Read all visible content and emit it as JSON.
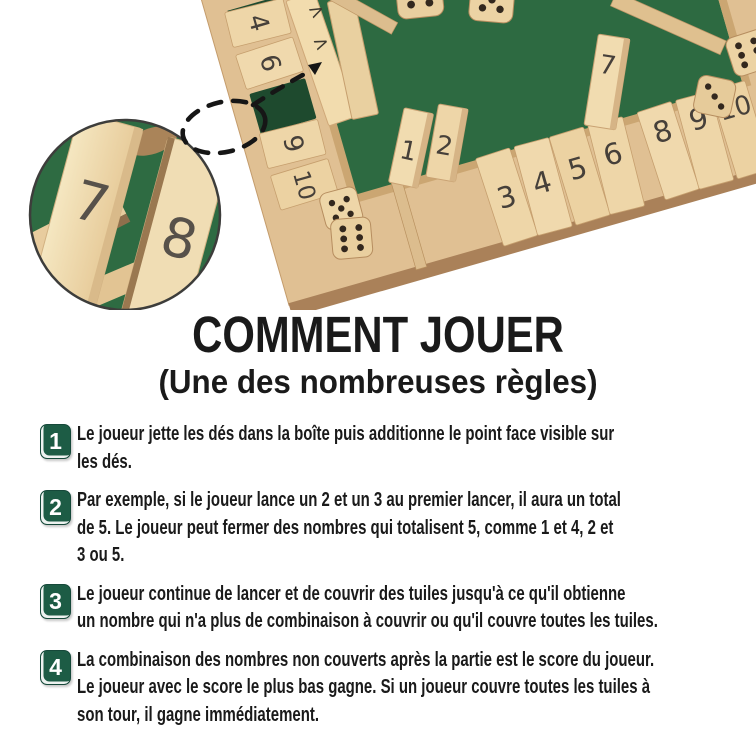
{
  "title": "COMMENT JOUER",
  "subtitle": "(Une des nombreuses règles)",
  "steps": [
    {
      "number": "1",
      "lines": [
        "Le joueur jette les dés dans la boîte puis additionne le point face visible sur",
        "les dés."
      ]
    },
    {
      "number": "2",
      "lines": [
        "Par exemple, si le joueur lance un 2 et un 3 au premier lancer, il aura un total",
        "de 5. Le joueur peut fermer des nombres qui totalisent 5, comme 1 et 4, 2 et",
        "3 ou 5."
      ]
    },
    {
      "number": "3",
      "lines": [
        "Le joueur continue de lancer et de couvrir des tuiles jusqu'à ce qu'il obtienne",
        "un nombre qui n'a plus de combinaison à couvrir ou qu'il couvre toutes les tuiles."
      ]
    },
    {
      "number": "4",
      "lines": [
        "La combinaison des nombres non couverts après la partie est le score du joueur.",
        "Le joueur avec le score le plus bas gagne. Si un joueur couvre toutes les tuiles à",
        "son tour, il gagne immédiatement."
      ]
    }
  ],
  "hero": {
    "description": "Photo of a four-player wooden Shut-The-Box game board with green felt, numbered flip tiles and wooden dice; a dashed callout magnifies the open slots of tiles 7 and 8",
    "board": {
      "left_rail_tiles": [
        "4",
        "6",
        "9",
        "10"
      ],
      "bottom_standing_tiles": [
        "1",
        "2"
      ],
      "bottom_flat_tiles_left": [
        "3",
        "4",
        "5",
        "6"
      ],
      "bottom_flag_tile": "7",
      "bottom_flat_tiles_right": [
        "8",
        "9",
        "10"
      ],
      "arrow_mark": ">"
    },
    "magnifier_tiles": {
      "left": "7",
      "right": "8"
    },
    "dice": [
      {
        "pips": 4
      },
      {
        "pips": 5
      },
      {
        "pips": 5
      },
      {
        "pips": 6
      },
      {
        "pips": 6
      },
      {
        "pips": 3
      }
    ],
    "colors": {
      "felt_green": "#2d6a41",
      "wood": "#e0c093",
      "wood_light": "#f1dcb0",
      "wood_dark": "#aa8159"
    }
  },
  "colors": {
    "badge_green": "#1d5c45",
    "text": "#1a1a1a",
    "background": "#ffffff"
  }
}
